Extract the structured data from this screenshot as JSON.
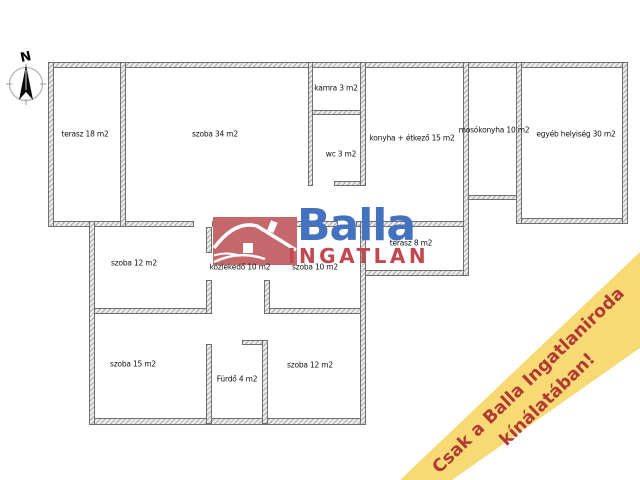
{
  "canvas": {
    "width": 640,
    "height": 480,
    "background": "#ffffff"
  },
  "compass": {
    "north_label": "N"
  },
  "logo": {
    "brand": "Balla",
    "brand_sub": "INGATLAN",
    "brand_color": "#4472be",
    "sub_color": "#c2474e",
    "house_color": "#c4686c"
  },
  "banner": {
    "line1": "Csak a Balla Ingatlaniroda",
    "line2": "kínálatában!",
    "background": "#f7da74",
    "text_color": "#b23a36"
  },
  "rooms": [
    {
      "id": "terasz-18",
      "label": "terasz 18 m2"
    },
    {
      "id": "szoba-34",
      "label": "szoba 34 m2"
    },
    {
      "id": "kamra-3",
      "label": "kamra 3 m2"
    },
    {
      "id": "wc-3",
      "label": "wc 3 m2"
    },
    {
      "id": "konyha-etkezo-15",
      "label": "konyha + étkező 15 m2"
    },
    {
      "id": "mosokonyha-10",
      "label": "mosókonyha 10 m2"
    },
    {
      "id": "egyeb-helyiseg-30",
      "label": "egyéb helyiség 30 m2"
    },
    {
      "id": "szoba-12-kozep",
      "label": "szoba 12 m2"
    },
    {
      "id": "kozlekedo-10",
      "label": "közlekedő 10 m2"
    },
    {
      "id": "szoba-10",
      "label": "szoba 10 m2"
    },
    {
      "id": "terasz-8",
      "label": "terasz 8 m2"
    },
    {
      "id": "szoba-15",
      "label": "szoba 15 m2"
    },
    {
      "id": "furdo-4",
      "label": "Fürdő 4 m2"
    },
    {
      "id": "szoba-12-also",
      "label": "szoba 12 m2"
    }
  ],
  "wall_colors": {
    "fill": "#ececec",
    "hatch": "#ababab",
    "border": "#6f6f6f"
  }
}
